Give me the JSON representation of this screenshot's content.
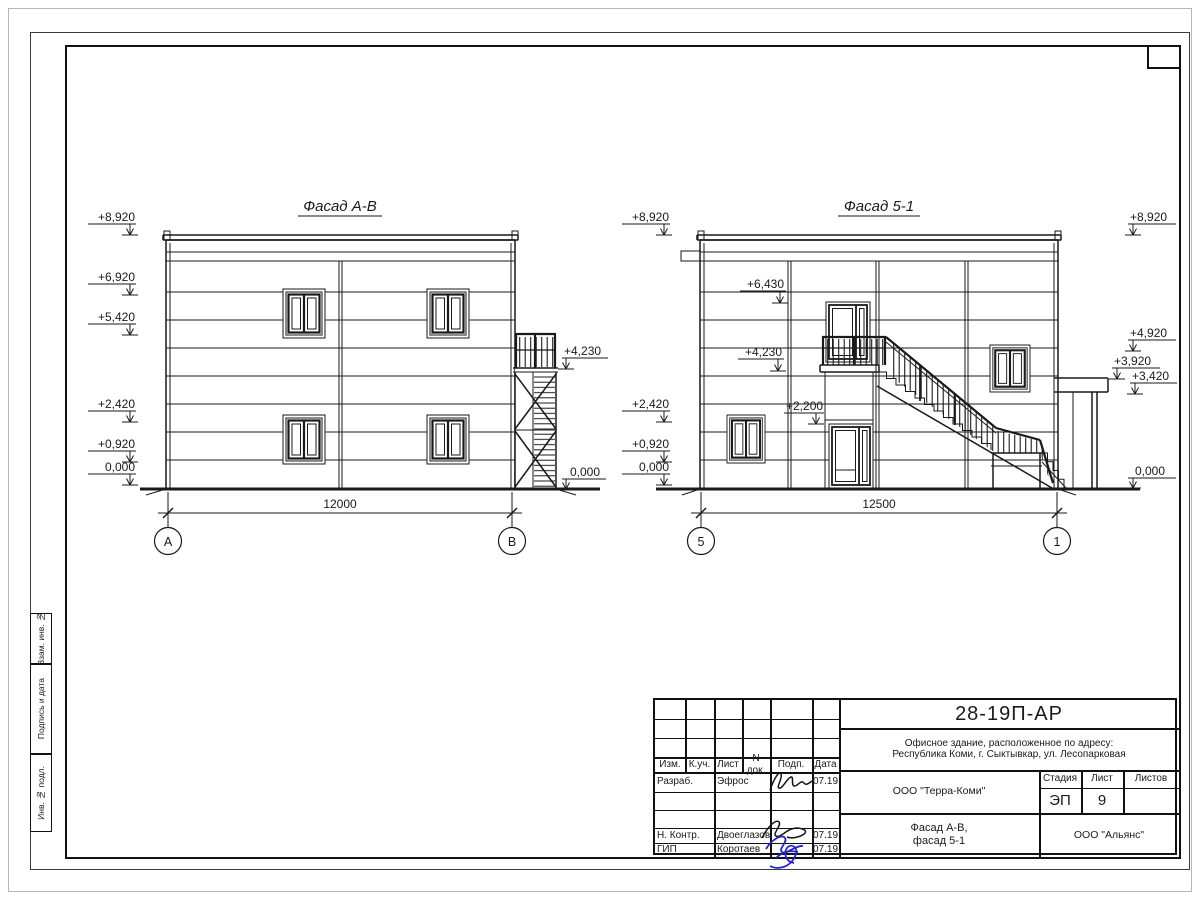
{
  "sheet": {
    "margin_labels": [
      "Взам. инв. №",
      "Подпись и дата",
      "Инв. № подл."
    ]
  },
  "facade_ab": {
    "title": "Фасад А-В",
    "marks_left": [
      "+8,920",
      "+6,920",
      "+5,420",
      "+2,420",
      "+0,920",
      "0,000"
    ],
    "marks_right": [
      "+4,230",
      "0,000"
    ],
    "dimension": "12000",
    "axes": [
      "А",
      "В"
    ]
  },
  "facade_51": {
    "title": "Фасад 5-1",
    "marks_left": [
      "+8,920",
      "+2,420",
      "+0,920",
      "0,000"
    ],
    "marks_inner": [
      "+6,430",
      "+4,230",
      "+2,200"
    ],
    "marks_right": [
      "+8,920",
      "+4,920",
      "+3,920",
      "+3,420",
      "0,000"
    ],
    "dimension": "12500",
    "axes": [
      "5",
      "1"
    ]
  },
  "titleblock": {
    "doc_number": "28-19П-АР",
    "address_line1": "Офисное здание, расположенное по адресу:",
    "address_line2": "Республика Коми, г. Сыктывкар, ул. Лесопарковая",
    "header_cols": [
      "Изм.",
      "К.уч.",
      "Лист",
      "N док.",
      "Подп.",
      "Дата"
    ],
    "row_developer_role": "Разраб.",
    "row_developer_name": "Эфрос",
    "row_developer_date": "07.19",
    "row_ncontrol_role": "Н. Контр.",
    "row_ncontrol_name": "Двоеглазов",
    "row_ncontrol_date": "07.19",
    "row_gip_role": "ГИП",
    "row_gip_name": "Коротаев",
    "row_gip_date": "07.19",
    "company": "ООО \"Терра-Коми\"",
    "stage_label": "Стадия",
    "sheet_label": "Лист",
    "sheets_label": "Листов",
    "stage_value": "ЭП",
    "sheet_value": "9",
    "sheets_value": "",
    "subtitle_line1": "Фасад А-В,",
    "subtitle_line2": "фасад 5-1",
    "contractor": "ООО \"Альянс\""
  },
  "colors": {
    "line": "#1a1a1a",
    "signature_blue": "#2424cc"
  }
}
